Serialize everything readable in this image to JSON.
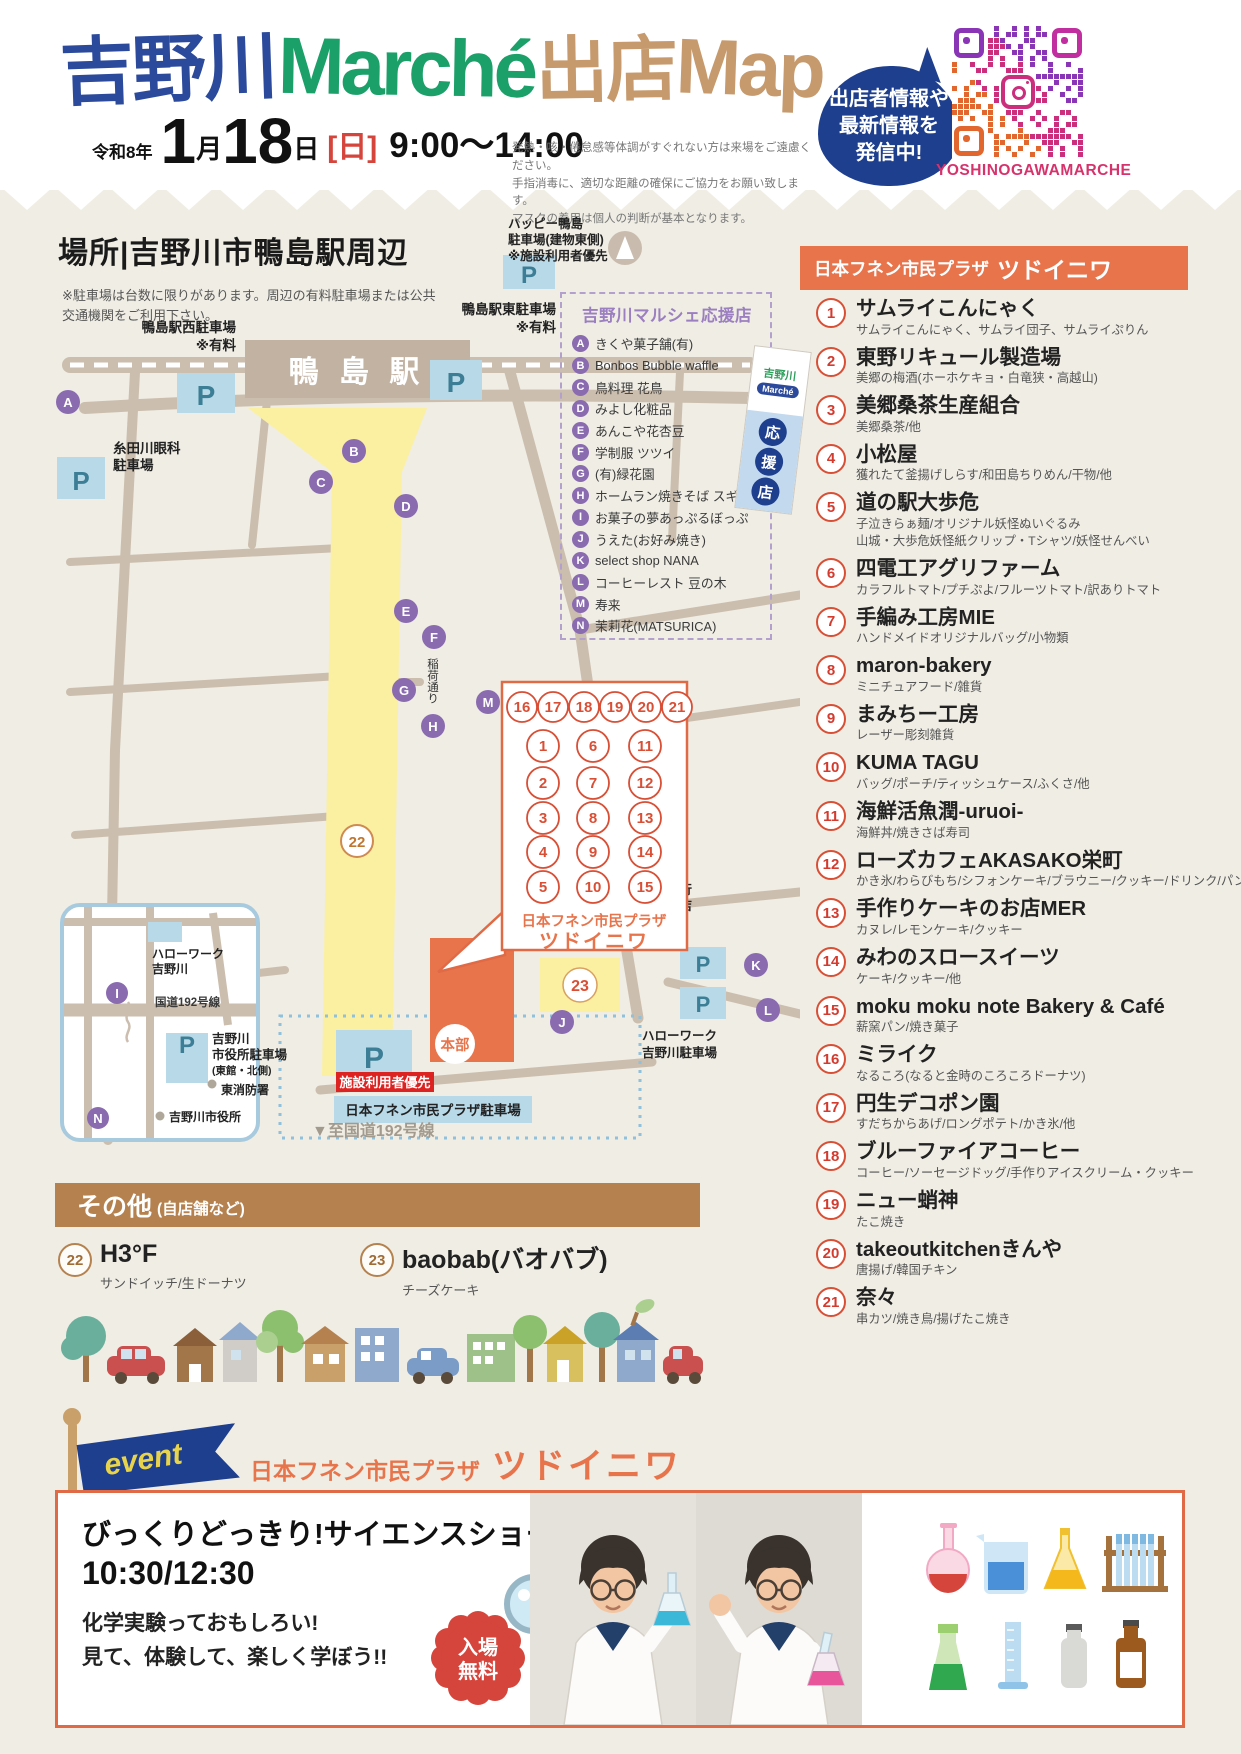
{
  "header": {
    "title1": "吉野川",
    "title2": "Marché",
    "title3": "出店",
    "title4": "Map",
    "era": "令和8年",
    "date_m": "1",
    "unit_m": "月",
    "date_d": "18",
    "unit_d": "日",
    "weekday": "[日]",
    "time": "9:00〜14:00",
    "notice": [
      "発熱・咳・倦怠感等体調がすぐれない方は来場をご遠慮ください。",
      "手指消毒に、適切な距離の確保にご協力をお願い致します。",
      "マスクの着用は個人の判断が基本となります。"
    ],
    "bubble": [
      "出店者情報や",
      "最新情報を",
      "発信中!"
    ],
    "qr_caption": "YOSHINOGAWAMARCHE"
  },
  "map": {
    "heading": "場所|吉野川市鴨島駅周辺",
    "notes": [
      "※駐車場は台数に限りがあります。周辺の有料駐車場または公共",
      "交通機関をご利用下さい。"
    ],
    "p": "P",
    "station": "鴨 島 駅",
    "west_parking": [
      "鴨島駅西駐車場",
      "※有料"
    ],
    "east_parking": [
      "鴨島駅東駐車場",
      "※有料"
    ],
    "itoda": [
      "糸田川眼科",
      "駐車場"
    ],
    "happy": [
      "ハッピー鴨島",
      "駐車場(建物東側)",
      "※施設利用者優先"
    ],
    "inari": "稲荷通り",
    "awabank": [
      "阿波銀行",
      "鴨島支店",
      "駐車場"
    ],
    "hellowork_pk": [
      "ハローワーク",
      "吉野川駐車場"
    ],
    "to_route": "▼至国道192号線",
    "priority": "施設利用者優先",
    "plaza_parking": "日本フネン市民プラザ駐車場",
    "honbu": "本部",
    "inset": {
      "hellowork": [
        "ハローワーク",
        "吉野川"
      ],
      "route": "国道192号線",
      "cityhall_pk": [
        "吉野川",
        "市役所駐車場",
        "(東館・北側)"
      ],
      "fire": "東消防署",
      "cityhall": "吉野川市役所"
    },
    "booth_caption": [
      "日本フネン市民プラザ",
      "ツドイニワ"
    ],
    "booths": {
      "top": [
        "16",
        "17",
        "18",
        "19",
        "20",
        "21"
      ],
      "col1": [
        "1",
        "2",
        "3",
        "4",
        "5"
      ],
      "col2": [
        "6",
        "7",
        "8",
        "9",
        "10"
      ],
      "col3": [
        "11",
        "12",
        "13",
        "14",
        "15"
      ]
    },
    "support": {
      "title": "吉野川マルシェ応援店",
      "stores": [
        {
          "l": "A",
          "n": "きくや菓子舗(有)"
        },
        {
          "l": "B",
          "n": "Bonbos Bubble waffle"
        },
        {
          "l": "C",
          "n": "鳥料理 花鳥"
        },
        {
          "l": "D",
          "n": "みよし化粧品"
        },
        {
          "l": "E",
          "n": "あんこや花杏豆"
        },
        {
          "l": "F",
          "n": "学制服 ツツイ"
        },
        {
          "l": "G",
          "n": "(有)緑花園"
        },
        {
          "l": "H",
          "n": "ホームラン焼きそば スギドン"
        },
        {
          "l": "I",
          "n": "お菓子の夢あっぷるぼっぷ"
        },
        {
          "l": "J",
          "n": "うえた(お好み焼き)"
        },
        {
          "l": "K",
          "n": "select shop NANA"
        },
        {
          "l": "L",
          "n": "コーヒーレスト 豆の木"
        },
        {
          "l": "M",
          "n": "寿来"
        },
        {
          "l": "N",
          "n": "茉莉花(MATSURICA)"
        }
      ]
    },
    "flag": {
      "logo_top": "吉野川",
      "logo_bottom": "Marché",
      "chars": [
        "応",
        "援",
        "店"
      ]
    }
  },
  "plaza": {
    "header_small": "日本フネン市民プラザ",
    "header_large": "ツドイニワ",
    "vendors": [
      {
        "num": "1",
        "name": "サムライこんにゃく",
        "desc": "サムライこんにゃく、サムライ団子、サムライぷりん"
      },
      {
        "num": "2",
        "name": "東野リキュール製造場",
        "desc": "美郷の梅酒(ホーホケキョ・白竜狭・高越山)"
      },
      {
        "num": "3",
        "name": "美郷桑茶生産組合",
        "desc": "美郷桑茶/他"
      },
      {
        "num": "4",
        "name": "小松屋",
        "desc": "獲れたて釜揚げしらす/和田島ちりめん/干物/他"
      },
      {
        "num": "5",
        "name": "道の駅大歩危",
        "desc": "子泣きらぁ麺/オリジナル妖怪ぬいぐるみ",
        "desc2": "山城・大歩危妖怪紙クリップ・Tシャツ/妖怪せんべい"
      },
      {
        "num": "6",
        "name": "四電工アグリファーム",
        "desc": "カラフルトマト/プチぷよ/フルーツトマト/訳ありトマト"
      },
      {
        "num": "7",
        "name": "手編み工房MIE",
        "desc": "ハンドメイドオリジナルバッグ/小物類"
      },
      {
        "num": "8",
        "name": "maron-bakery",
        "desc": "ミニチュアフード/雑貨"
      },
      {
        "num": "9",
        "name": "まみちー工房",
        "desc": "レーザー彫刻雑貨"
      },
      {
        "num": "10",
        "name": "KUMA TAGU",
        "desc": "バッグ/ポーチ/ティッシュケース/ふくさ/他"
      },
      {
        "num": "11",
        "name": "海鮮活魚潤-uruoi-",
        "desc": "海鮮丼/焼きさば寿司"
      },
      {
        "num": "12",
        "name": "ローズカフェAKASAKO栄町",
        "desc": "かき氷/わらびもち/シフォンケーキ/ブラウニー/クッキー/ドリンク/パンケーキ"
      },
      {
        "num": "13",
        "name": "手作りケーキのお店MER",
        "desc": "カヌレ/レモンケーキ/クッキー"
      },
      {
        "num": "14",
        "name": "みわのスロースイーツ",
        "desc": "ケーキ/クッキー/他"
      },
      {
        "num": "15",
        "name": "moku moku note Bakery & Café",
        "desc": "薪窯パン/焼き菓子"
      },
      {
        "num": "16",
        "name": "ミライク",
        "desc": "なるころ(なると金時のころころドーナツ)"
      },
      {
        "num": "17",
        "name": "円生デコポン園",
        "desc": "すだちからあげ/ロングポテト/かき氷/他"
      },
      {
        "num": "18",
        "name": "ブルーファイアコーヒー",
        "desc": "コーヒー/ソーセージドッグ/手作りアイスクリーム・クッキー"
      },
      {
        "num": "19",
        "name": "ニュー蛸神",
        "desc": "たこ焼き"
      },
      {
        "num": "20",
        "name": "takeoutkitchenきんや",
        "desc": "唐揚げ/韓国チキン"
      },
      {
        "num": "21",
        "name": "奈々",
        "desc": "串カツ/焼き鳥/揚げたこ焼き"
      }
    ]
  },
  "others": {
    "title": "その他",
    "subtitle": "(自店舗など)",
    "items": [
      {
        "num": "22",
        "name": "H3°F",
        "desc": "サンドイッチ/生ドーナツ"
      },
      {
        "num": "23",
        "name": "baobab(バオバブ)",
        "desc": "チーズケーキ"
      }
    ]
  },
  "event": {
    "tag": "event",
    "venue_small": "日本フネン市民プラザ",
    "venue_large": "ツドイニワ",
    "title": "びっくりどっきり!サイエンスショー",
    "time": "10:30/12:30",
    "lines": [
      "化学実験っておもしろい!",
      "見て、体験して、楽しく学ぼう!!"
    ],
    "badge": [
      "入場",
      "無料"
    ]
  }
}
